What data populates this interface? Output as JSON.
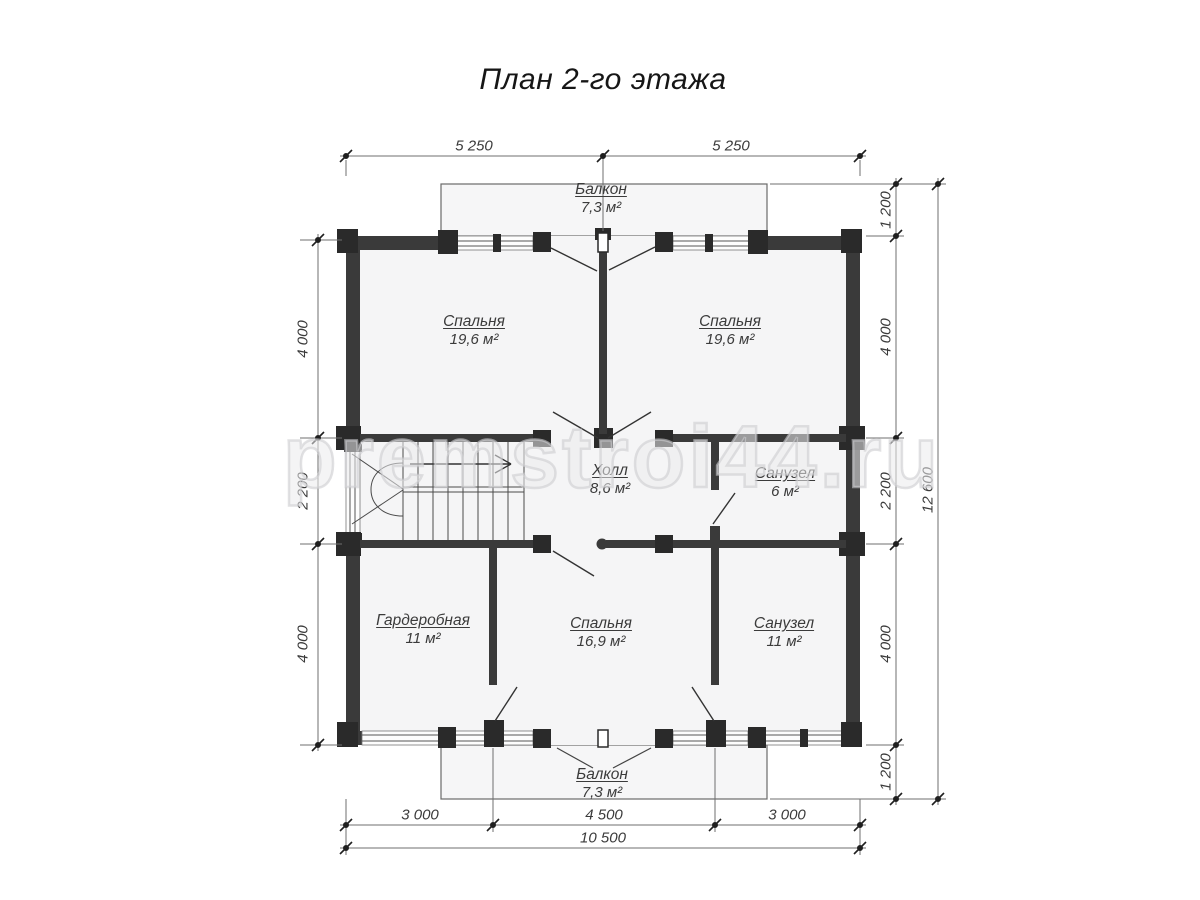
{
  "title": "План 2-го этажа",
  "watermark": "premstroi44.ru",
  "rooms": [
    {
      "id": "balcony-top",
      "name": "Балкон",
      "area": "7,3 м²"
    },
    {
      "id": "bedroom-top-left",
      "name": "Спальня",
      "area": "19,6 м²"
    },
    {
      "id": "bedroom-top-right",
      "name": "Спальня",
      "area": "19,6 м²"
    },
    {
      "id": "hall",
      "name": "Холл",
      "area": "8,6 м²"
    },
    {
      "id": "bathroom-small",
      "name": "Санузел",
      "area": "6 м²"
    },
    {
      "id": "wardrobe",
      "name": "Гардеробная",
      "area": "11 м²"
    },
    {
      "id": "bedroom-bottom",
      "name": "Спальня",
      "area": "16,9 м²"
    },
    {
      "id": "bathroom-large",
      "name": "Санузел",
      "area": "11 м²"
    },
    {
      "id": "balcony-bottom",
      "name": "Балкон",
      "area": "7,3 м²"
    }
  ],
  "dims": {
    "top": [
      "5 250",
      "5 250"
    ],
    "left": [
      "4 000",
      "2 200",
      "4 000"
    ],
    "right": [
      "1 200",
      "4 000",
      "2 200",
      "4 000",
      "1 200"
    ],
    "right_total": "12 600",
    "bottom": [
      "3 000",
      "4 500",
      "3 000"
    ],
    "bottom_total": "10 500"
  },
  "colors": {
    "wall": "#3a3a3a",
    "wall_block": "#2a2a2a",
    "room_fill": "#f5f5f6",
    "line": "#555555",
    "dim_line": "#6f6f6f",
    "text": "#3b3b3b"
  }
}
